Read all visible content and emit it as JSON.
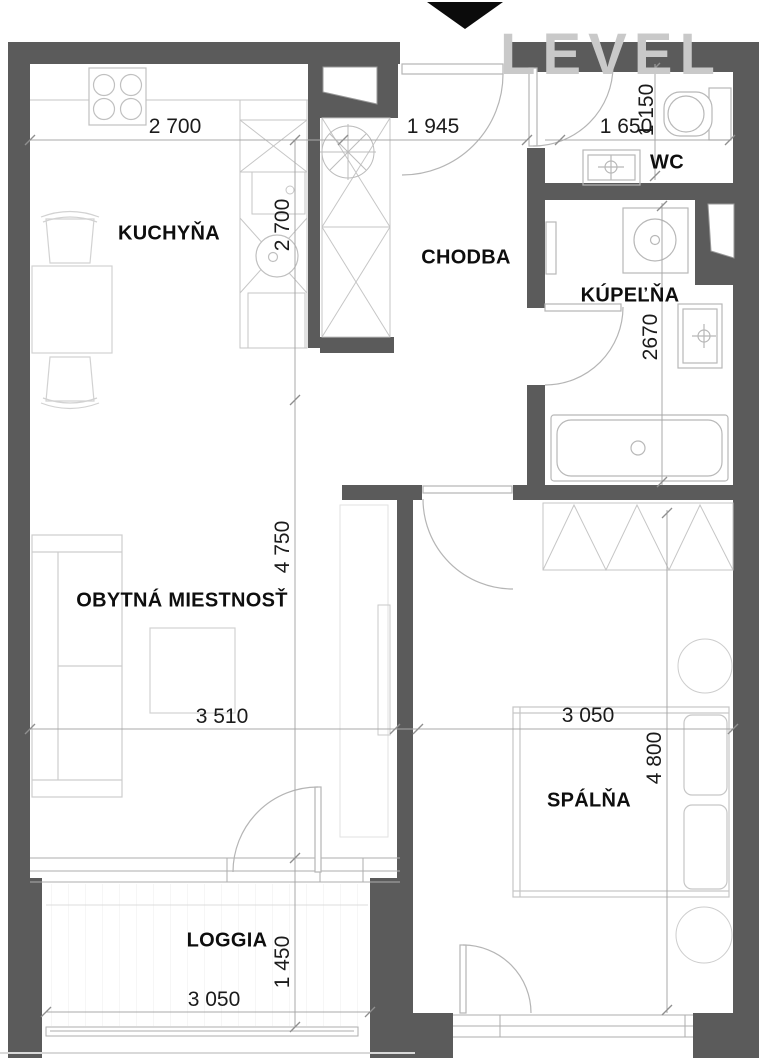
{
  "watermark": {
    "text": "LEVEL"
  },
  "rooms": {
    "kitchen": {
      "label": "KUCHYŇA"
    },
    "hallway": {
      "label": "CHODBA"
    },
    "wc": {
      "label": "WC"
    },
    "bathroom": {
      "label": "KÚPEĽŇA"
    },
    "living": {
      "label": "OBYTNÁ MIESTNOSŤ"
    },
    "bedroom": {
      "label": "SPÁLŇA"
    },
    "loggia": {
      "label": "LOGGIA"
    }
  },
  "dimensions": {
    "kitchen_width": "2 700",
    "kitchen_depth": "2 700",
    "hallway_width": "1 945",
    "wc_width": "1 650",
    "wc_depth": "1 150",
    "bathroom_depth": "2670",
    "living_width": "3 510",
    "living_depth": "4 750",
    "bedroom_width": "3 050",
    "bedroom_depth": "4 800",
    "loggia_width": "3 050",
    "loggia_depth": "1 450"
  },
  "colors": {
    "wall": "#5b5b5b",
    "furniture_line": "#c6c6c6",
    "dim_line": "#a8a8a8",
    "text": "#0e0e0e",
    "watermark": "#c9c9c9",
    "entrance_marker": "#0b0b0b"
  }
}
